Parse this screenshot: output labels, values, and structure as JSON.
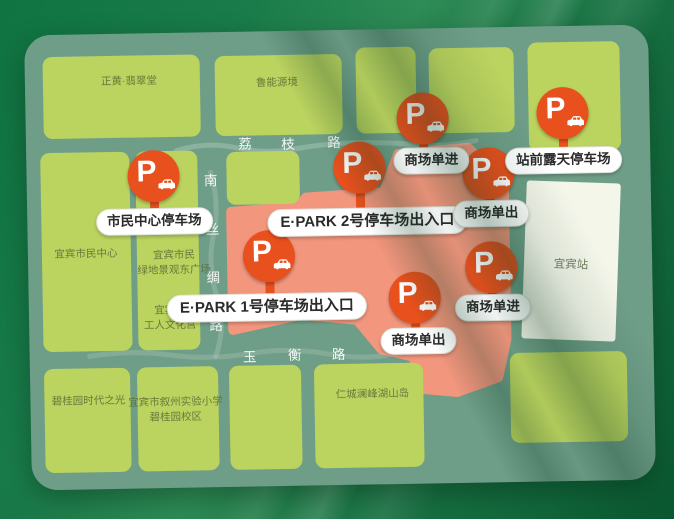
{
  "map": {
    "pin_letter": "P",
    "pins": [
      {
        "id": "civic-center",
        "label": "市民中心停车场"
      },
      {
        "id": "epark-2",
        "label": "E·PARK 2号停车场出入口"
      },
      {
        "id": "mall-entry-north",
        "label": "商场单进"
      },
      {
        "id": "station-front",
        "label": "站前露天停车场"
      },
      {
        "id": "mall-exit-east",
        "label": "商场单出"
      },
      {
        "id": "epark-1",
        "label": "E·PARK 1号停车场出入口"
      },
      {
        "id": "mall-exit-south",
        "label": "商场单出"
      },
      {
        "id": "mall-entry-east",
        "label": "商场单进"
      }
    ],
    "roads": [
      {
        "name": "荔枝路",
        "orientation": "horizontal",
        "chars": [
          "荔",
          "枝",
          "路"
        ]
      },
      {
        "name": "南丝绸路",
        "orientation": "vertical",
        "chars": [
          "南",
          "丝",
          "绸",
          "路"
        ]
      },
      {
        "name": "玉衡路",
        "orientation": "horizontal",
        "chars": [
          "玉",
          "衡",
          "路"
        ]
      }
    ],
    "blocks": [
      {
        "label": "正黄·翡翠堂"
      },
      {
        "label": "鲁能源境"
      },
      {
        "label": "宜宾市民中心"
      },
      {
        "lines": [
          "宜宾市民",
          "绿地景观东广场"
        ]
      },
      {
        "lines": [
          "宜宾市",
          "工人文化宫"
        ]
      },
      {
        "label": "碧桂园时代之光"
      },
      {
        "lines": [
          "宜宾市叙州实验小学",
          "碧桂园校区"
        ]
      },
      {
        "label": "仁城澜峰湖山岛"
      }
    ],
    "station": {
      "label": "宜宾站"
    },
    "colors": {
      "pin_orange": "#E8501D",
      "block_green": "#BBD35F",
      "road_green": "#6F9E88",
      "mall_area_pink": "#F2967D",
      "station_white": "#F4F6EA",
      "background_green": "#11713F",
      "label_text": "#2B2B2B"
    }
  }
}
